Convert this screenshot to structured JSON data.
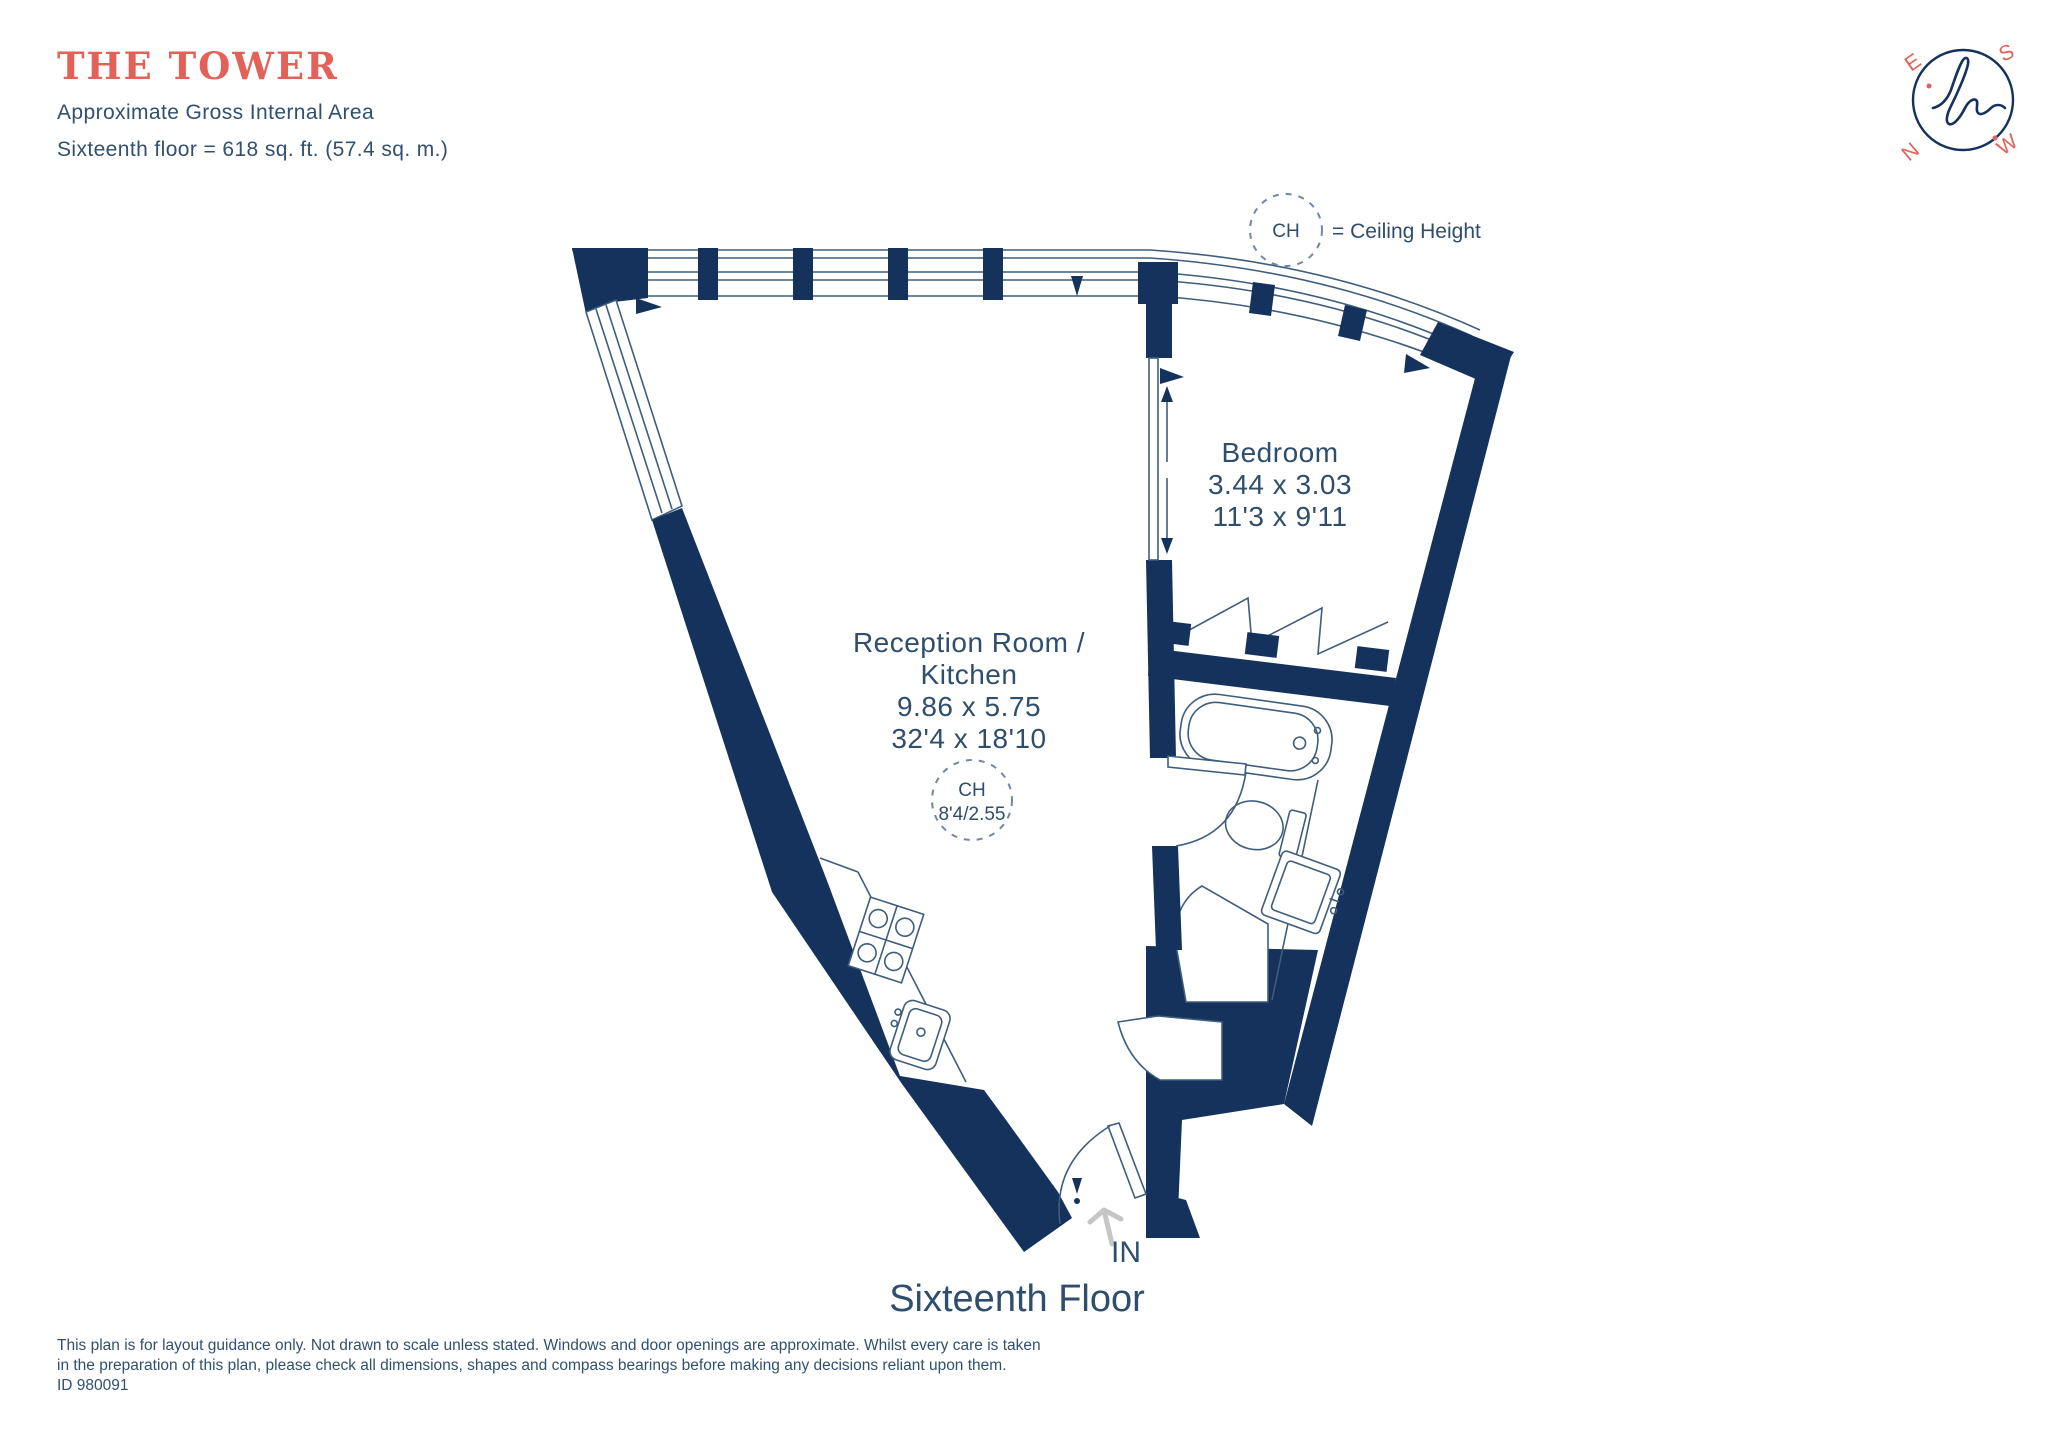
{
  "header": {
    "title": "THE TOWER",
    "subtitle": "Approximate Gross Internal Area",
    "area_line": "Sixteenth floor = 618 sq. ft. (57.4 sq. m.)"
  },
  "legend": {
    "ch_abbr": "CH",
    "ch_meaning": "= Ceiling Height"
  },
  "compass": {
    "north": "N",
    "east": "E",
    "south": "S",
    "west": "W"
  },
  "rooms": {
    "reception": {
      "name_line1": "Reception Room /",
      "name_line2": "Kitchen",
      "dims_metric": "9.86 x 5.75",
      "dims_imperial": "32'4 x 18'10",
      "ch_abbr": "CH",
      "ch_value": "8'4/2.55"
    },
    "bedroom": {
      "name": "Bedroom",
      "dims_metric": "3.44 x 3.03",
      "dims_imperial": "11'3 x 9'11"
    }
  },
  "entrance": {
    "label": "IN"
  },
  "floor_label": "Sixteenth Floor",
  "footer": {
    "line1": "This plan is for layout guidance only. Not drawn to scale unless stated. Windows and door openings are approximate. Whilst every care is taken",
    "line2": "in the preparation of this plan, please check all dimensions, shapes and compass bearings before making any decisions reliant upon them.",
    "plan_id": "ID 980091"
  },
  "colors": {
    "wall": "#14325c",
    "accent": "#e2625a",
    "text": "#2f4e6e",
    "fixture_line": "#3f5d7c",
    "arrow_gray": "#c6c6c6"
  }
}
